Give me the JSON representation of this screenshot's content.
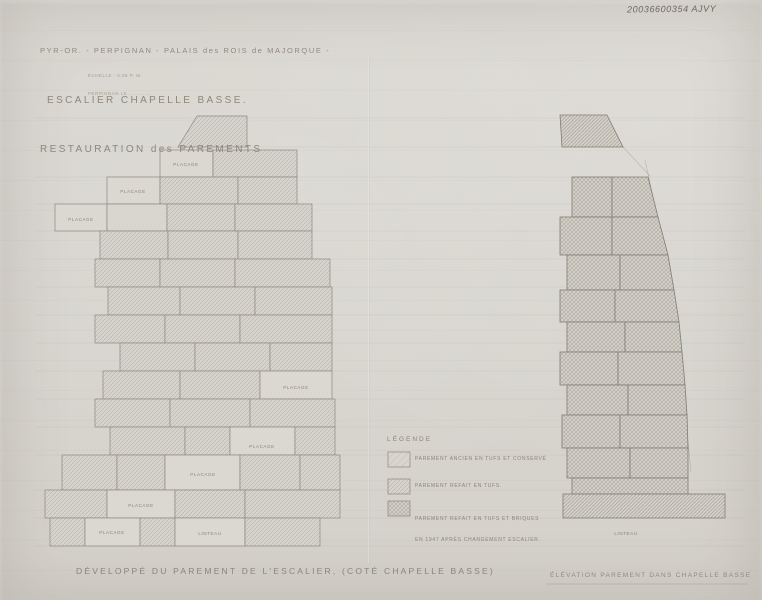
{
  "meta": {
    "reference_number": "20036600354 AJVY"
  },
  "title_block": {
    "line1": "PYR-OR. - PERPIGNAN - PALAIS des ROIS de MAJORQUE -",
    "line2": "ESCALIER CHAPELLE BASSE.",
    "line3": "RESTAURATION des PAREMENTS",
    "scale_note_line1": "ÉCHELLE : 0,05 P. M.",
    "scale_note_line2": "PERPIGNAN LE ............"
  },
  "legend": {
    "header": "LÉGENDE",
    "entries": [
      {
        "swatch": "sparse-diagonal-hatch",
        "label": "PAREMENT ANCIEN EN TUFS ET CONSERVÉ"
      },
      {
        "swatch": "diagonal-hatch",
        "label": "PAREMENT REFAIT EN TUFS."
      },
      {
        "swatch": "cross-hatch",
        "label": "PAREMENT REFAIT EN TUFS ET BRIQUES",
        "label_line2": "EN 1947 APRÈS CHANGEMENT ESCALIER."
      }
    ]
  },
  "left_drawing": {
    "caption": "DÉVELOPPÉ DU PAREMENT DE L'ESCALIER, (COTÉ CHAPELLE BASSE)",
    "labels": [
      "PLACAGE",
      "PLACAGE",
      "PLACAGE",
      "PLACAGE",
      "PLACAGE",
      "PLACAGE",
      "PLACAGE",
      "PLACAGE",
      "LINTEAU"
    ]
  },
  "right_drawing": {
    "caption": "ÉLÉVATION PAREMENT DANS CHAPELLE BASSE",
    "labels": [
      "LINTEAU"
    ]
  },
  "colors": {
    "paper": "#d7d4ce",
    "pencil_line": "#8e897e",
    "pencil_text": "#8d887d",
    "handwriting": "#6f695e"
  }
}
